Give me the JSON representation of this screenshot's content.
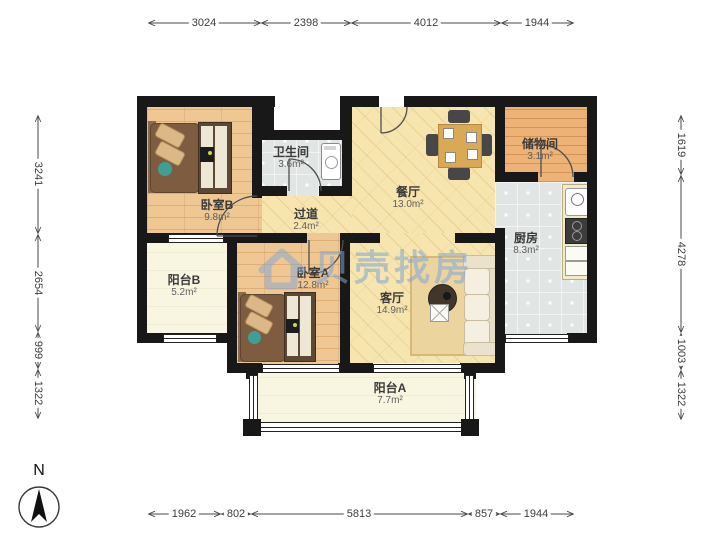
{
  "title": "apartment-floor-plan",
  "watermark": {
    "text": "贝壳找房",
    "color": "#7ea6d6"
  },
  "north": {
    "label": "N"
  },
  "colors": {
    "wall": "#181818",
    "wood_main": "#f6e5ae",
    "wood_bedroom": "#efc793",
    "wood_storage": "#ecb276",
    "tile": "#e1e5e3",
    "balcony": "#f8f5e1"
  },
  "rooms": [
    {
      "id": "bedroom-b",
      "name": "卧室B",
      "area": "9.8m²"
    },
    {
      "id": "bathroom",
      "name": "卫生间",
      "area": "3.6m²"
    },
    {
      "id": "hallway",
      "name": "过道",
      "area": "2.4m²"
    },
    {
      "id": "dining",
      "name": "餐厅",
      "area": "13.0m²"
    },
    {
      "id": "storage",
      "name": "储物间",
      "area": "3.1m²"
    },
    {
      "id": "kitchen",
      "name": "厨房",
      "area": "8.3m²"
    },
    {
      "id": "balcony-b",
      "name": "阳台B",
      "area": "5.2m²"
    },
    {
      "id": "bedroom-a",
      "name": "卧室A",
      "area": "12.8m²"
    },
    {
      "id": "living",
      "name": "客厅",
      "area": "14.9m²"
    },
    {
      "id": "balcony-a",
      "name": "阳台A",
      "area": "7.7m²"
    }
  ],
  "dimensions": {
    "top": [
      "3024",
      "2398",
      "4012",
      "1944"
    ],
    "bottom": [
      "1962",
      "802",
      "5813",
      "857",
      "1944"
    ],
    "left": [
      "3241",
      "2654",
      "999",
      "1322"
    ],
    "right": [
      "1619",
      "4278",
      "1003",
      "1322"
    ]
  }
}
